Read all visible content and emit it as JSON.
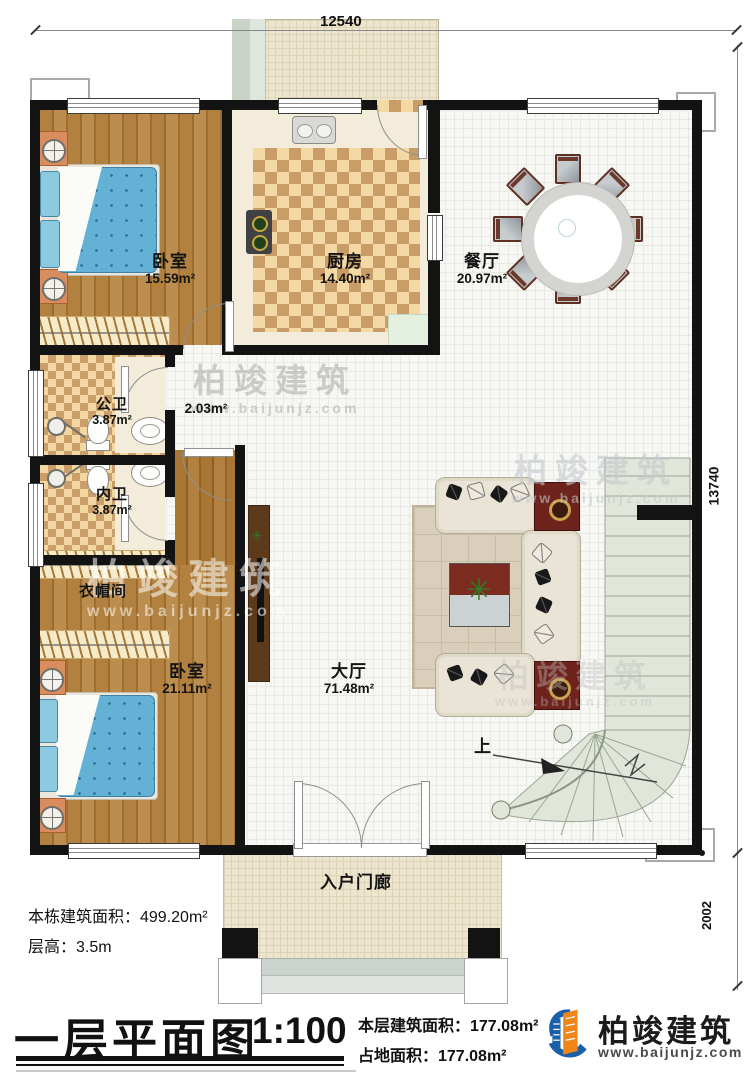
{
  "dims": {
    "top": "12540",
    "right": "13740",
    "right_lower": "2002"
  },
  "rooms": {
    "bedroom1": {
      "name": "卧室",
      "area": "15.59m²"
    },
    "kitchen": {
      "name": "厨房",
      "area": "14.40m²"
    },
    "dining": {
      "name": "餐厅",
      "area": "20.97m²"
    },
    "public_bath": {
      "name": "公卫",
      "area": "3.87m²"
    },
    "hallway": {
      "area": "2.03m²"
    },
    "private_bath": {
      "name": "内卫",
      "area": "3.87m²"
    },
    "cloakroom": {
      "name": "衣帽间"
    },
    "bedroom2": {
      "name": "卧室",
      "area": "21.11m²"
    },
    "hall": {
      "name": "大厅",
      "area": "71.48m²"
    },
    "porch": {
      "name": "入户门廊"
    },
    "stairs_up_label": "上"
  },
  "notes": {
    "total_area": "本栋建筑面积：499.20m²",
    "floor_height": "层高：3.5m"
  },
  "titleblock": {
    "title": "一层平面图",
    "scale": "1:100",
    "floor_area": "本层建筑面积：177.08m²",
    "footprint": "占地面积：177.08m²"
  },
  "brand": {
    "name": "柏竣建筑",
    "site": "www.baijunjz.com"
  },
  "watermark": {
    "name": "柏竣建筑",
    "site": "www.baijunjz.com"
  },
  "colors": {
    "wall": "#131313",
    "brand_blue": "#1a5fa8",
    "brand_orange": "#f08519",
    "stair": "#e0e7da"
  }
}
